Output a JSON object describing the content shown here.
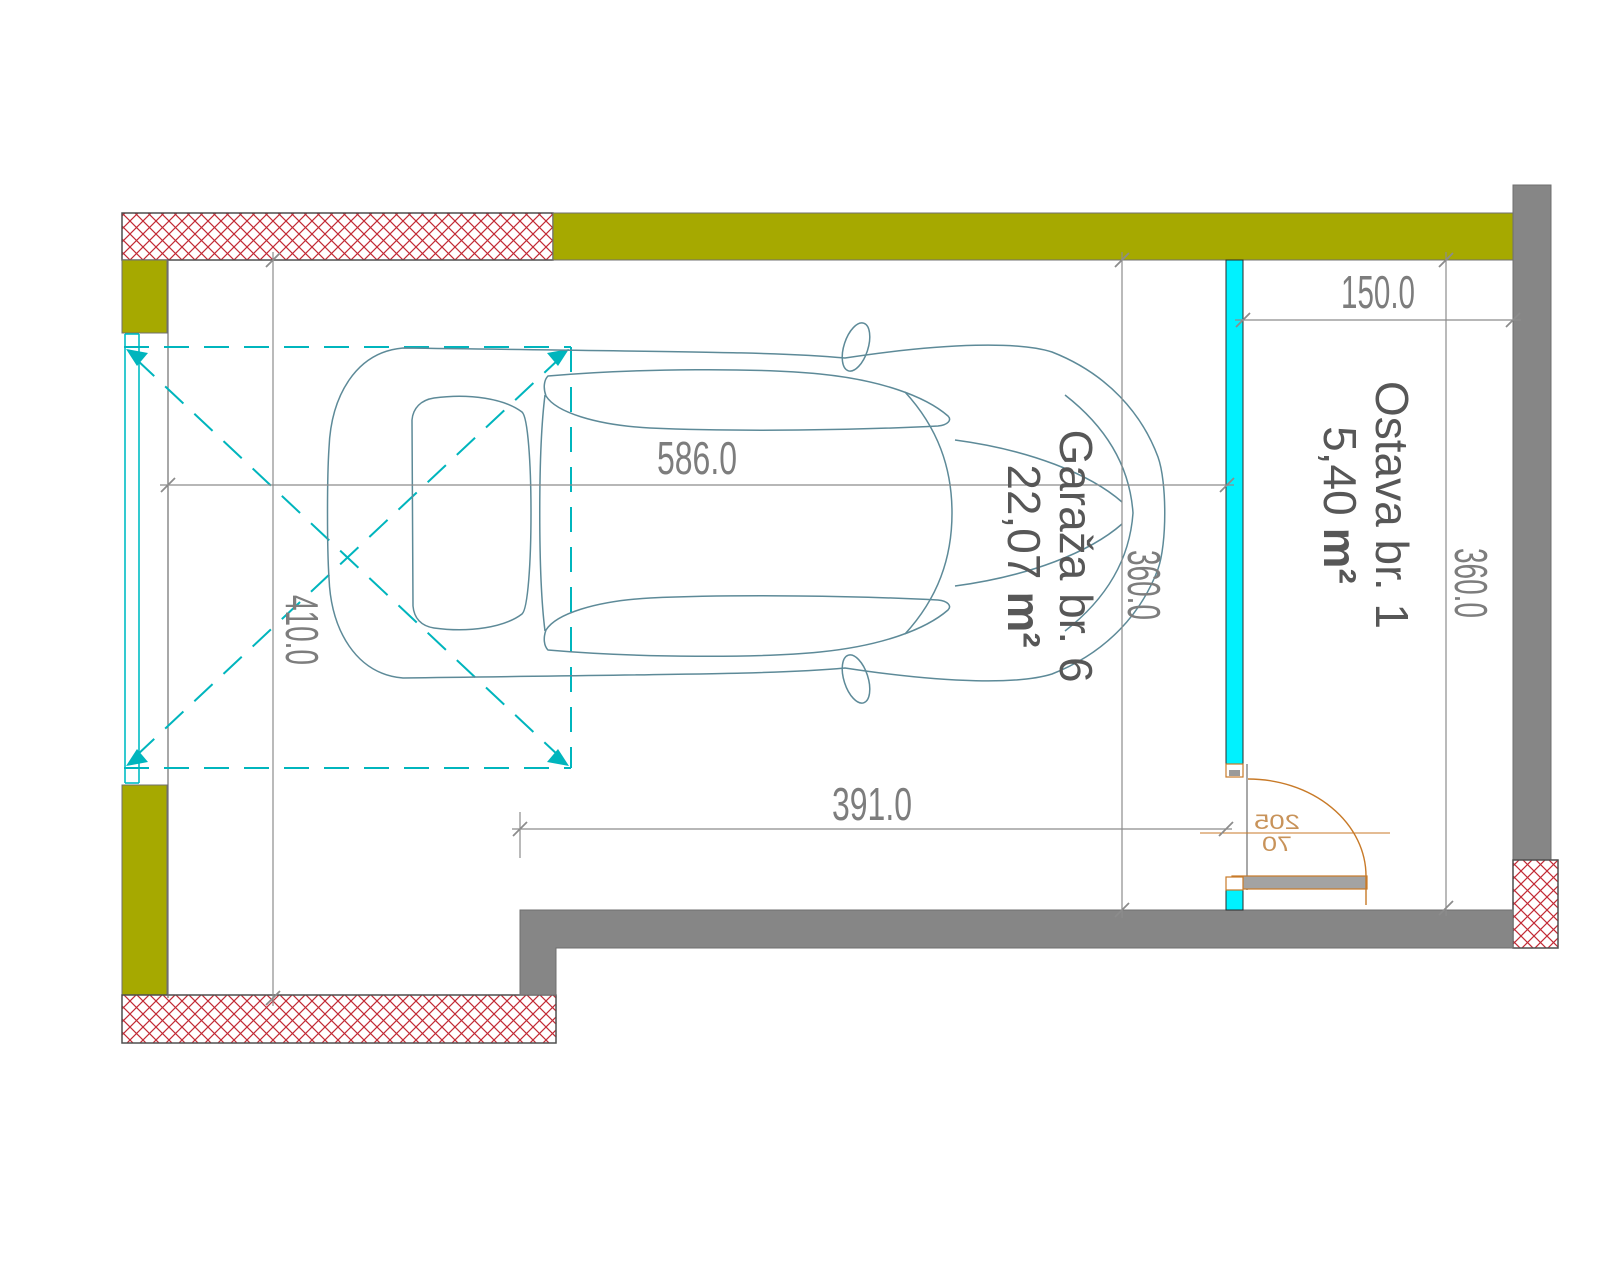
{
  "plan": {
    "rooms": [
      {
        "name": "Garaža br. 6",
        "area": "22,07",
        "unit": "m²"
      },
      {
        "name": "Ostava br. 1",
        "area": "5,40",
        "unit": "m²"
      }
    ],
    "dims": {
      "garage_length": "586.0",
      "garage_clear_length": "391.0",
      "garage_width": "410.0",
      "garage_depth": "360.0",
      "storage_depth": "360.0",
      "storage_width": "150.0"
    },
    "door": {
      "height": "205",
      "width": "70"
    },
    "colors": {
      "wall_olive": "#a6a900",
      "wall_gray": "#868686",
      "hatch_red": "#c22a35",
      "partition_cyan": "#00f2ff",
      "parking_cyan": "#00b5bd",
      "car_outline": "#5d8a98",
      "dimension_gray": "#8c8c8c",
      "door_orange": "#c87a28"
    }
  }
}
